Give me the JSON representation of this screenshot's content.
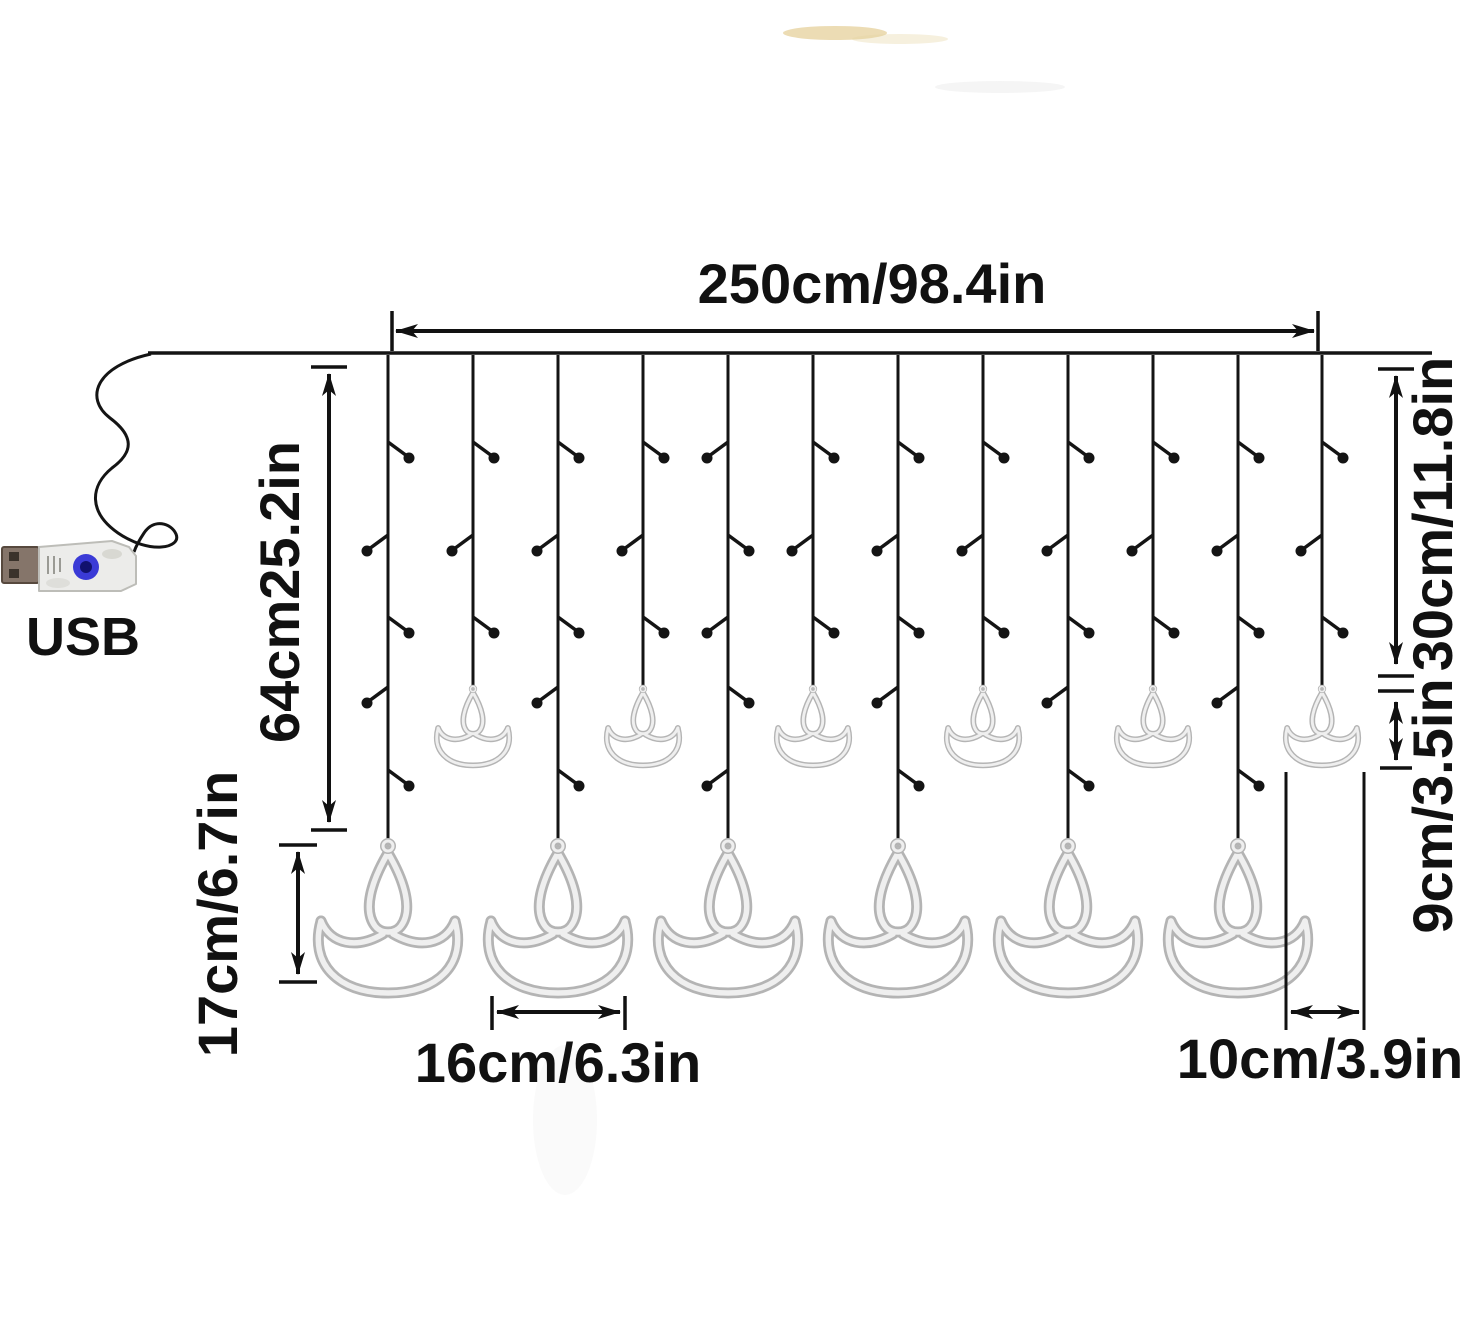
{
  "labels": {
    "total_width": "250cm/98.4in",
    "left_drop": "64cm25.2in",
    "right_drop": "30cm/11.8in",
    "small_diya_height": "9cm/3.5in",
    "large_diya_height": "17cm/6.7in",
    "large_diya_width": "16cm/6.3in",
    "small_diya_width": "10cm/3.9in",
    "usb": "USB"
  },
  "curtain": {
    "strings_count": 12,
    "large_diyas_count": 6,
    "small_diyas_count": 6
  },
  "colors": {
    "line": "#141414",
    "rope_outer": "#b4b4b4",
    "rope_inner": "#efefef",
    "usb_button": "#3a3ad6",
    "background": "#ffffff"
  }
}
